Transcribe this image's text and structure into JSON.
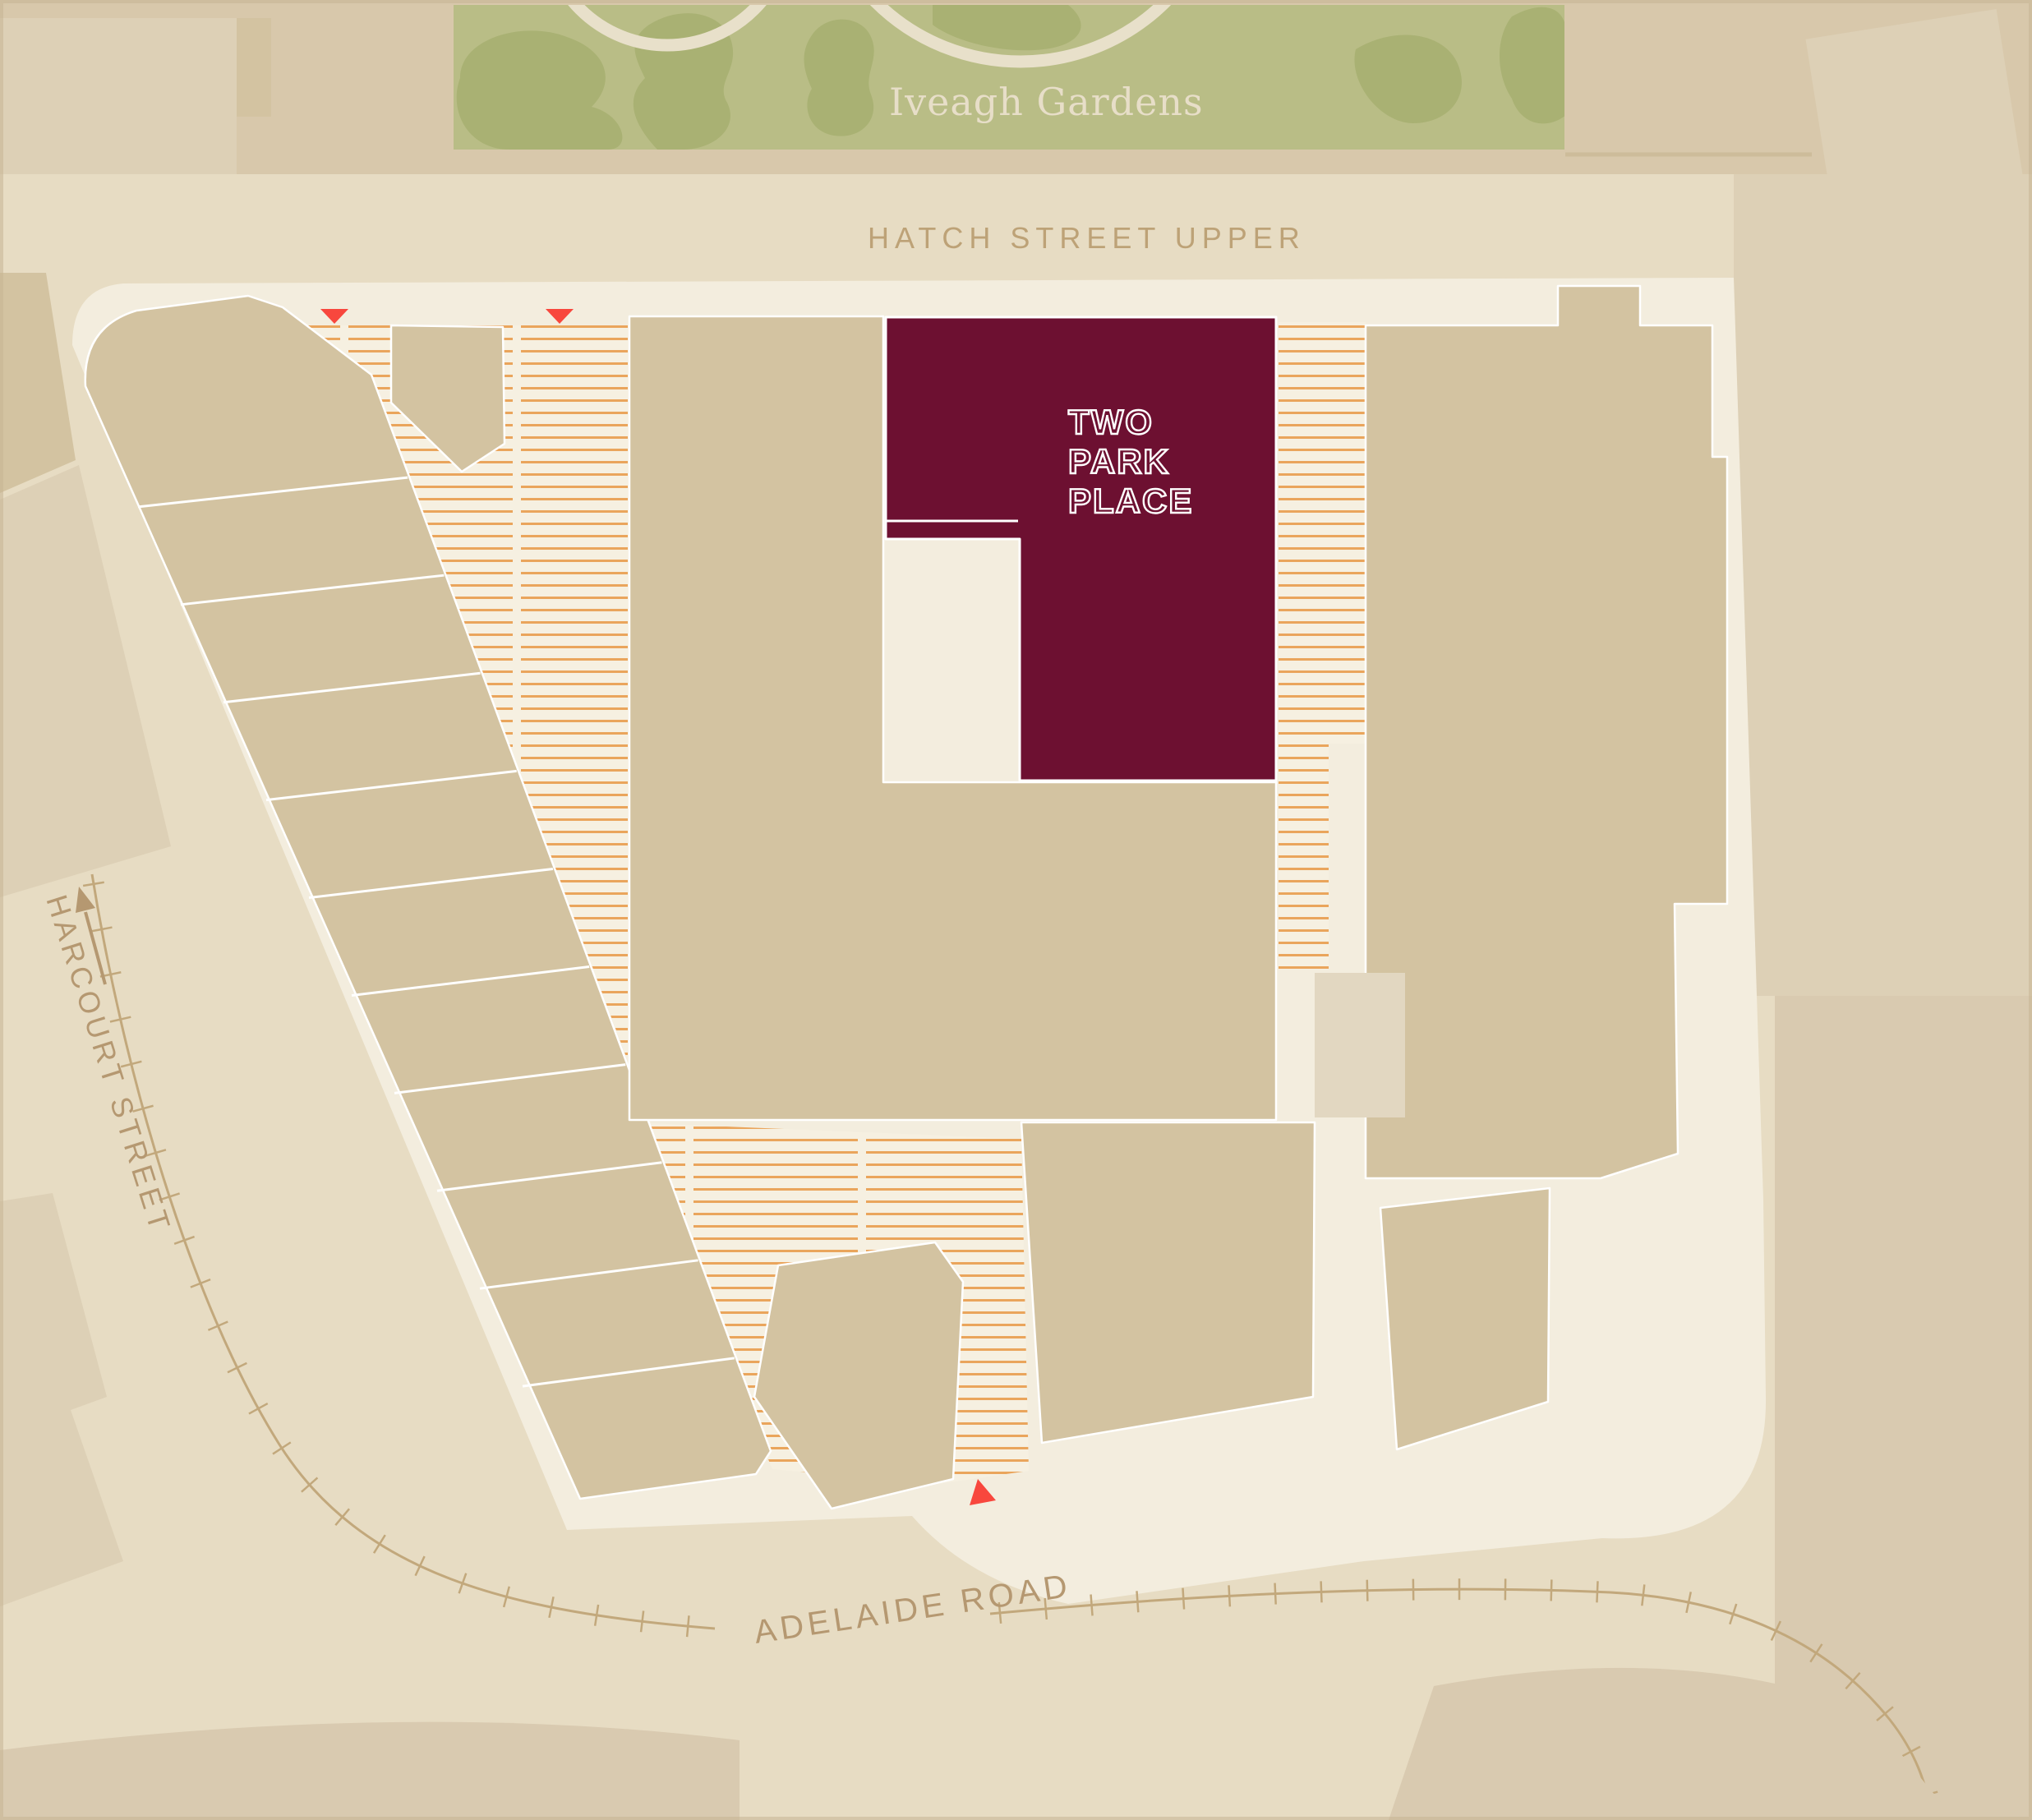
{
  "map": {
    "title": "Two Park Place site location map",
    "region_labels": {
      "park": "Iveagh Gardens",
      "street_top": "HATCH STREET UPPER",
      "street_left": "HARCOURT STREET",
      "street_bottom": "ADELAIDE ROAD"
    },
    "building": {
      "name_line1": "TWO",
      "name_line2": "PARK",
      "name_line3": "PLACE"
    },
    "markers": {
      "entrance_markers": 3
    },
    "icons": {
      "entrance_marker": "red-triangle-icon",
      "direction_arrow": "street-direction-arrow-icon",
      "tram_line": "tram-track-with-ticks"
    },
    "colors": {
      "bg": "#e7dcc3",
      "topStrip": "#d8c8ab",
      "blockLight": "#ddd0b6",
      "blockMid": "#d3c3a1",
      "building": "#d3c3a1",
      "site": "#f3edde",
      "hatchBg": "#f6f0e1",
      "hatchLine": "#eaa55c",
      "garden": "#b9bd86",
      "gardenDark": "#a9b173",
      "gardenPath": "#e8e0ca",
      "maroon": "#6d1031",
      "label": "#b59871",
      "labelHatch": "#bda277",
      "labelGarden": "#e7dec8",
      "red": "#f8473d",
      "tram": "#c2a87c",
      "bandDark": "#d9cab0",
      "lightSquare": "#e2d7c1",
      "wall": "#cdbc9a",
      "frame": "#c6b493"
    }
  }
}
